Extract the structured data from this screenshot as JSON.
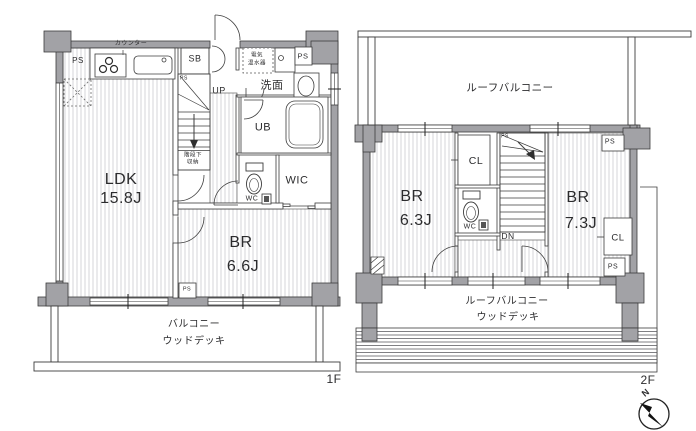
{
  "floor1": {
    "label": "1F",
    "ldk_name": "LDK",
    "ldk_size": "15.8J",
    "br_name": "BR",
    "br_size": "6.6J",
    "washroom": "洗面",
    "unit_bath": "UB",
    "wic": "WIC",
    "wc": "WC",
    "shoe_box": "SB",
    "up": "UP",
    "counter": "カウンター",
    "water_heater_l1": "電気",
    "water_heater_l2": "温水器",
    "stair_storage_l1": "階段下",
    "stair_storage_l2": "収納",
    "ps": "PS",
    "balcony": "バルコニー",
    "wood_deck": "ウッドデッキ"
  },
  "floor2": {
    "label": "2F",
    "roof_balcony": "ルーフバルコニー",
    "br1_name": "BR",
    "br1_size": "6.3J",
    "br2_name": "BR",
    "br2_size": "7.3J",
    "closet": "CL",
    "wc": "WC",
    "dn": "DN",
    "ps": "PS",
    "roof_balcony_bottom": "ルーフバルコニー",
    "wood_deck": "ウッドデッキ"
  },
  "compass": {
    "north": "N"
  }
}
